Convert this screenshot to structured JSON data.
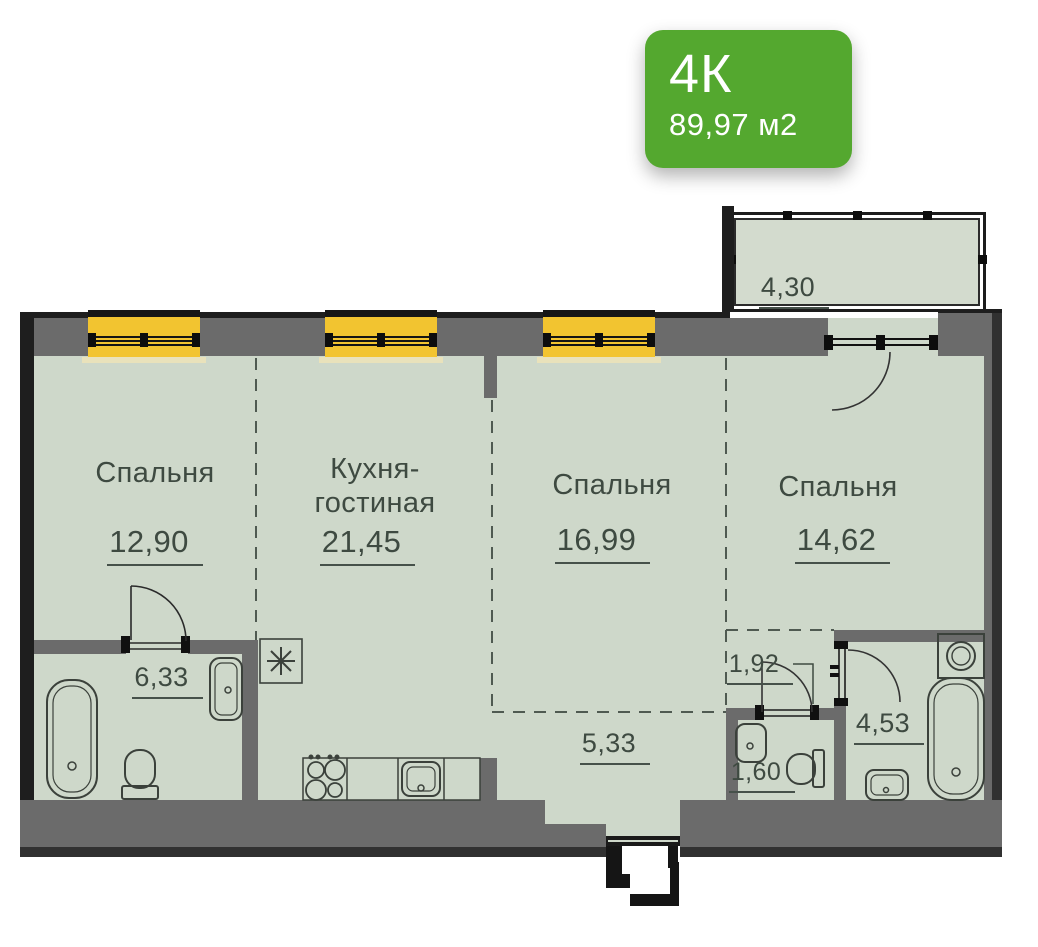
{
  "badge": {
    "type": "4К",
    "area": "89,97 м2"
  },
  "rooms": {
    "bedroom1": {
      "name": "Спальня",
      "area": "12,90"
    },
    "kitchen": {
      "name": "Кухня-гостиная",
      "area": "21,45"
    },
    "bedroom2": {
      "name": "Спальня",
      "area": "16,99"
    },
    "bedroom3": {
      "name": "Спальня",
      "area": "14,62"
    },
    "bathroom1": {
      "area": "6,33"
    },
    "hallway": {
      "area": "5,33"
    },
    "corridor": {
      "area": "1,92"
    },
    "wc": {
      "area": "1,60"
    },
    "bathroom2": {
      "area": "4,53"
    },
    "balcony": {
      "area": "4,30"
    }
  },
  "colors": {
    "badge_green": "#54a82f",
    "window_yellow": "#f2c430",
    "wall_gray": "#6b6b6b",
    "wall_dark": "#1e1e1e",
    "floor_sage": "#ced8ca",
    "label_green_gray": "#3e4a41"
  }
}
